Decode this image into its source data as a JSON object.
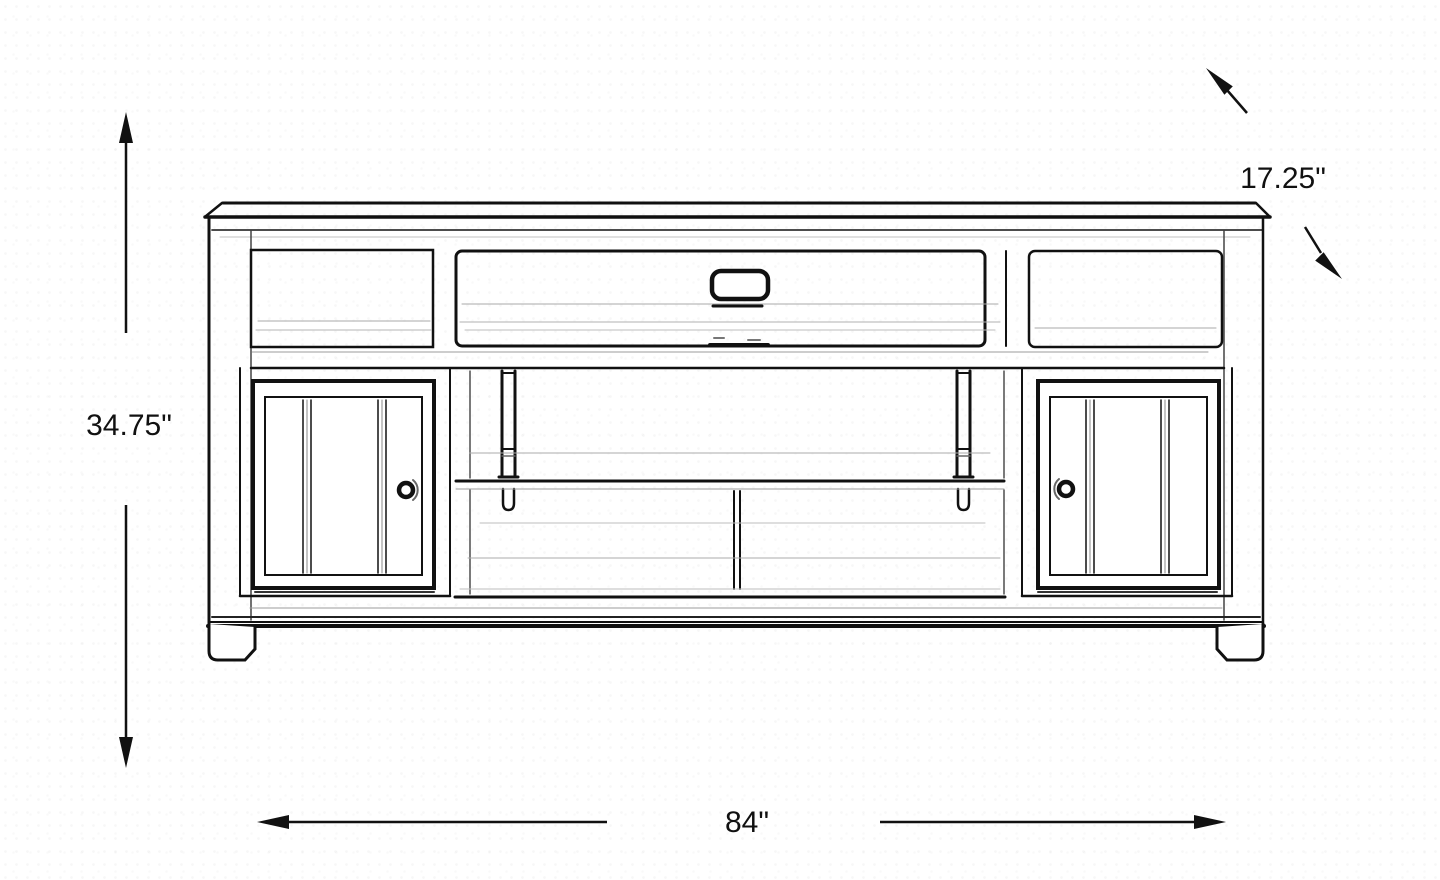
{
  "diagram": {
    "subject": "tv-console-dimension-sketch",
    "labels": {
      "height": "34.75\"",
      "width": "84\"",
      "depth": "17.25\""
    },
    "colors": {
      "background": "#ffffff",
      "ink": "#111111",
      "sketch_light": "#9b9b9b"
    }
  }
}
